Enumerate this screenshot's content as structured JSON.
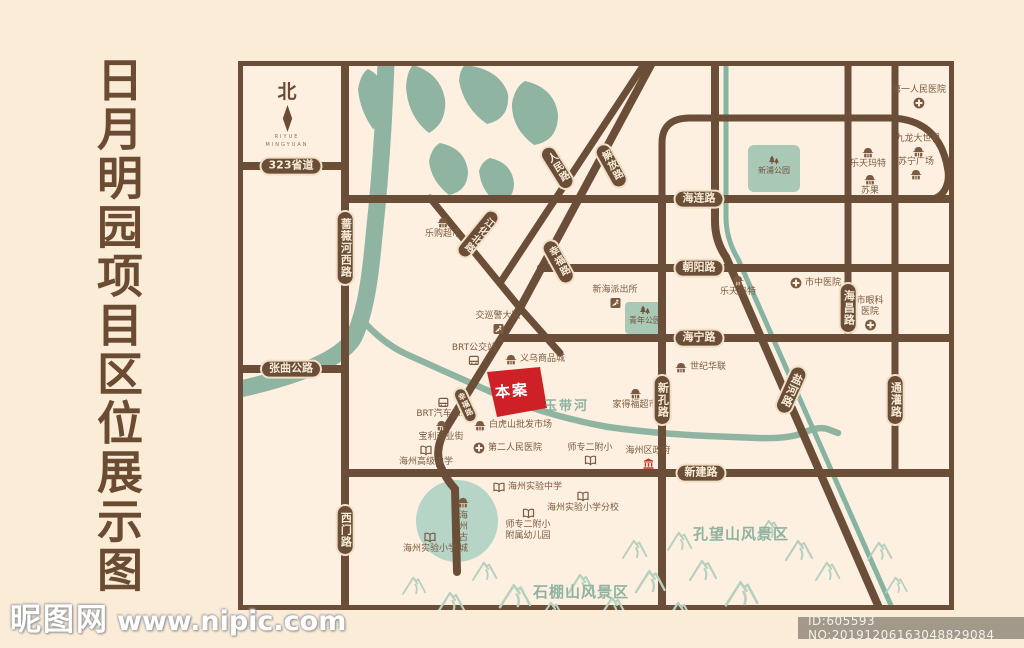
{
  "title": {
    "vertical_text": "日月明园项目区位展示图"
  },
  "compass": {
    "north_label": "北",
    "brand_line1": "RIYUE",
    "brand_line2": "MINGYUAN"
  },
  "site": {
    "label": "本案",
    "color": "#ce2127"
  },
  "colors": {
    "road_brown": "#6b4e38",
    "river_green": "#8fb4a1",
    "park_green": "#a9c8b6",
    "old_town_green": "#b6d5c7",
    "mountain_green": "#b7d1c1",
    "background": "#fbecd8",
    "map_background": "#fdf0e1",
    "site_red": "#ce2127",
    "gov_red": "#c2342c"
  },
  "icons": {
    "shop": "storefront-awning",
    "hospital": "circle-cross",
    "school": "open-book",
    "police": "badge-runner",
    "bus": "bus-front",
    "government": "classic-building",
    "tree": "pine-trees",
    "compass_needle": "kite-needle"
  },
  "roads": {
    "s323": "323省道",
    "zhangqu": "张曲公路",
    "hailian": "海连路",
    "chaoyang": "朝阳路",
    "haining": "海宁路",
    "xinjian": "新建路",
    "qiangwei": "蔷薇河西路",
    "ximen": "西门路",
    "xinkong": "新孔路",
    "haichang": "海昌路",
    "tongguan": "通灌路",
    "yanhe": "盐河路",
    "renmin": "人民路",
    "jiefang": "解放路",
    "xingfu": "幸福路",
    "xingfu2": "幸福路",
    "jianghua": "江化北路"
  },
  "rivers": {
    "yudaihe": "玉带河"
  },
  "areas": {
    "kongwangshan": "孔望山风景区",
    "shipengshan": "石棚山风景区",
    "gucheng": "海州古城",
    "xinpu_park": "新浦公园",
    "qingnian_park": "青年公园"
  },
  "pois": {
    "hosp1": {
      "label": "第一人民医院"
    },
    "jiulong": {
      "label": "九龙大世界"
    },
    "suning": {
      "label": "苏宁广场"
    },
    "lotte_ne": {
      "label": "乐天玛特"
    },
    "suguo": {
      "label": "苏果"
    },
    "legou": {
      "label": "乐购超市"
    },
    "xinhai_police": {
      "label": "新海派出所"
    },
    "lotte_mid": {
      "label": "乐天玛特"
    },
    "shizhong_hosp": {
      "label": "市中医院"
    },
    "yanke_hosp": {
      "line1": "市眼科",
      "line2": "医院"
    },
    "jiaoxunjing": {
      "label": "交巡警大队"
    },
    "brt_station": {
      "label": "BRT公交站"
    },
    "yiwu": {
      "label": "义乌商品城"
    },
    "shijihualian": {
      "label": "世纪华联"
    },
    "jiadefu": {
      "label": "家得福超市"
    },
    "brt_terminal": {
      "label": "BRT汽车总站"
    },
    "baoli": {
      "label": "宝利商业街"
    },
    "baihushan": {
      "label": "白虎山批发市场"
    },
    "gaoji_school": {
      "label": "海州高级中学"
    },
    "dier_hosp": {
      "label": "第二人民医院"
    },
    "shizhuaner": {
      "label": "师专二附小"
    },
    "qu_gov": {
      "label": "海州区政府"
    },
    "shiyan_zhong": {
      "label": "海州实验中学"
    },
    "shiyan_fenxiao": {
      "label": "海州实验小学分校"
    },
    "fuyou": {
      "line1": "师专二附小",
      "line2": "附属幼儿园"
    },
    "shiyan_xiao": {
      "label": "海州实验小学"
    }
  },
  "watermark": {
    "logo": "昵图网",
    "url": "www.nipic.com",
    "id_text": "ID:605593 NO:20191206163048829084"
  }
}
